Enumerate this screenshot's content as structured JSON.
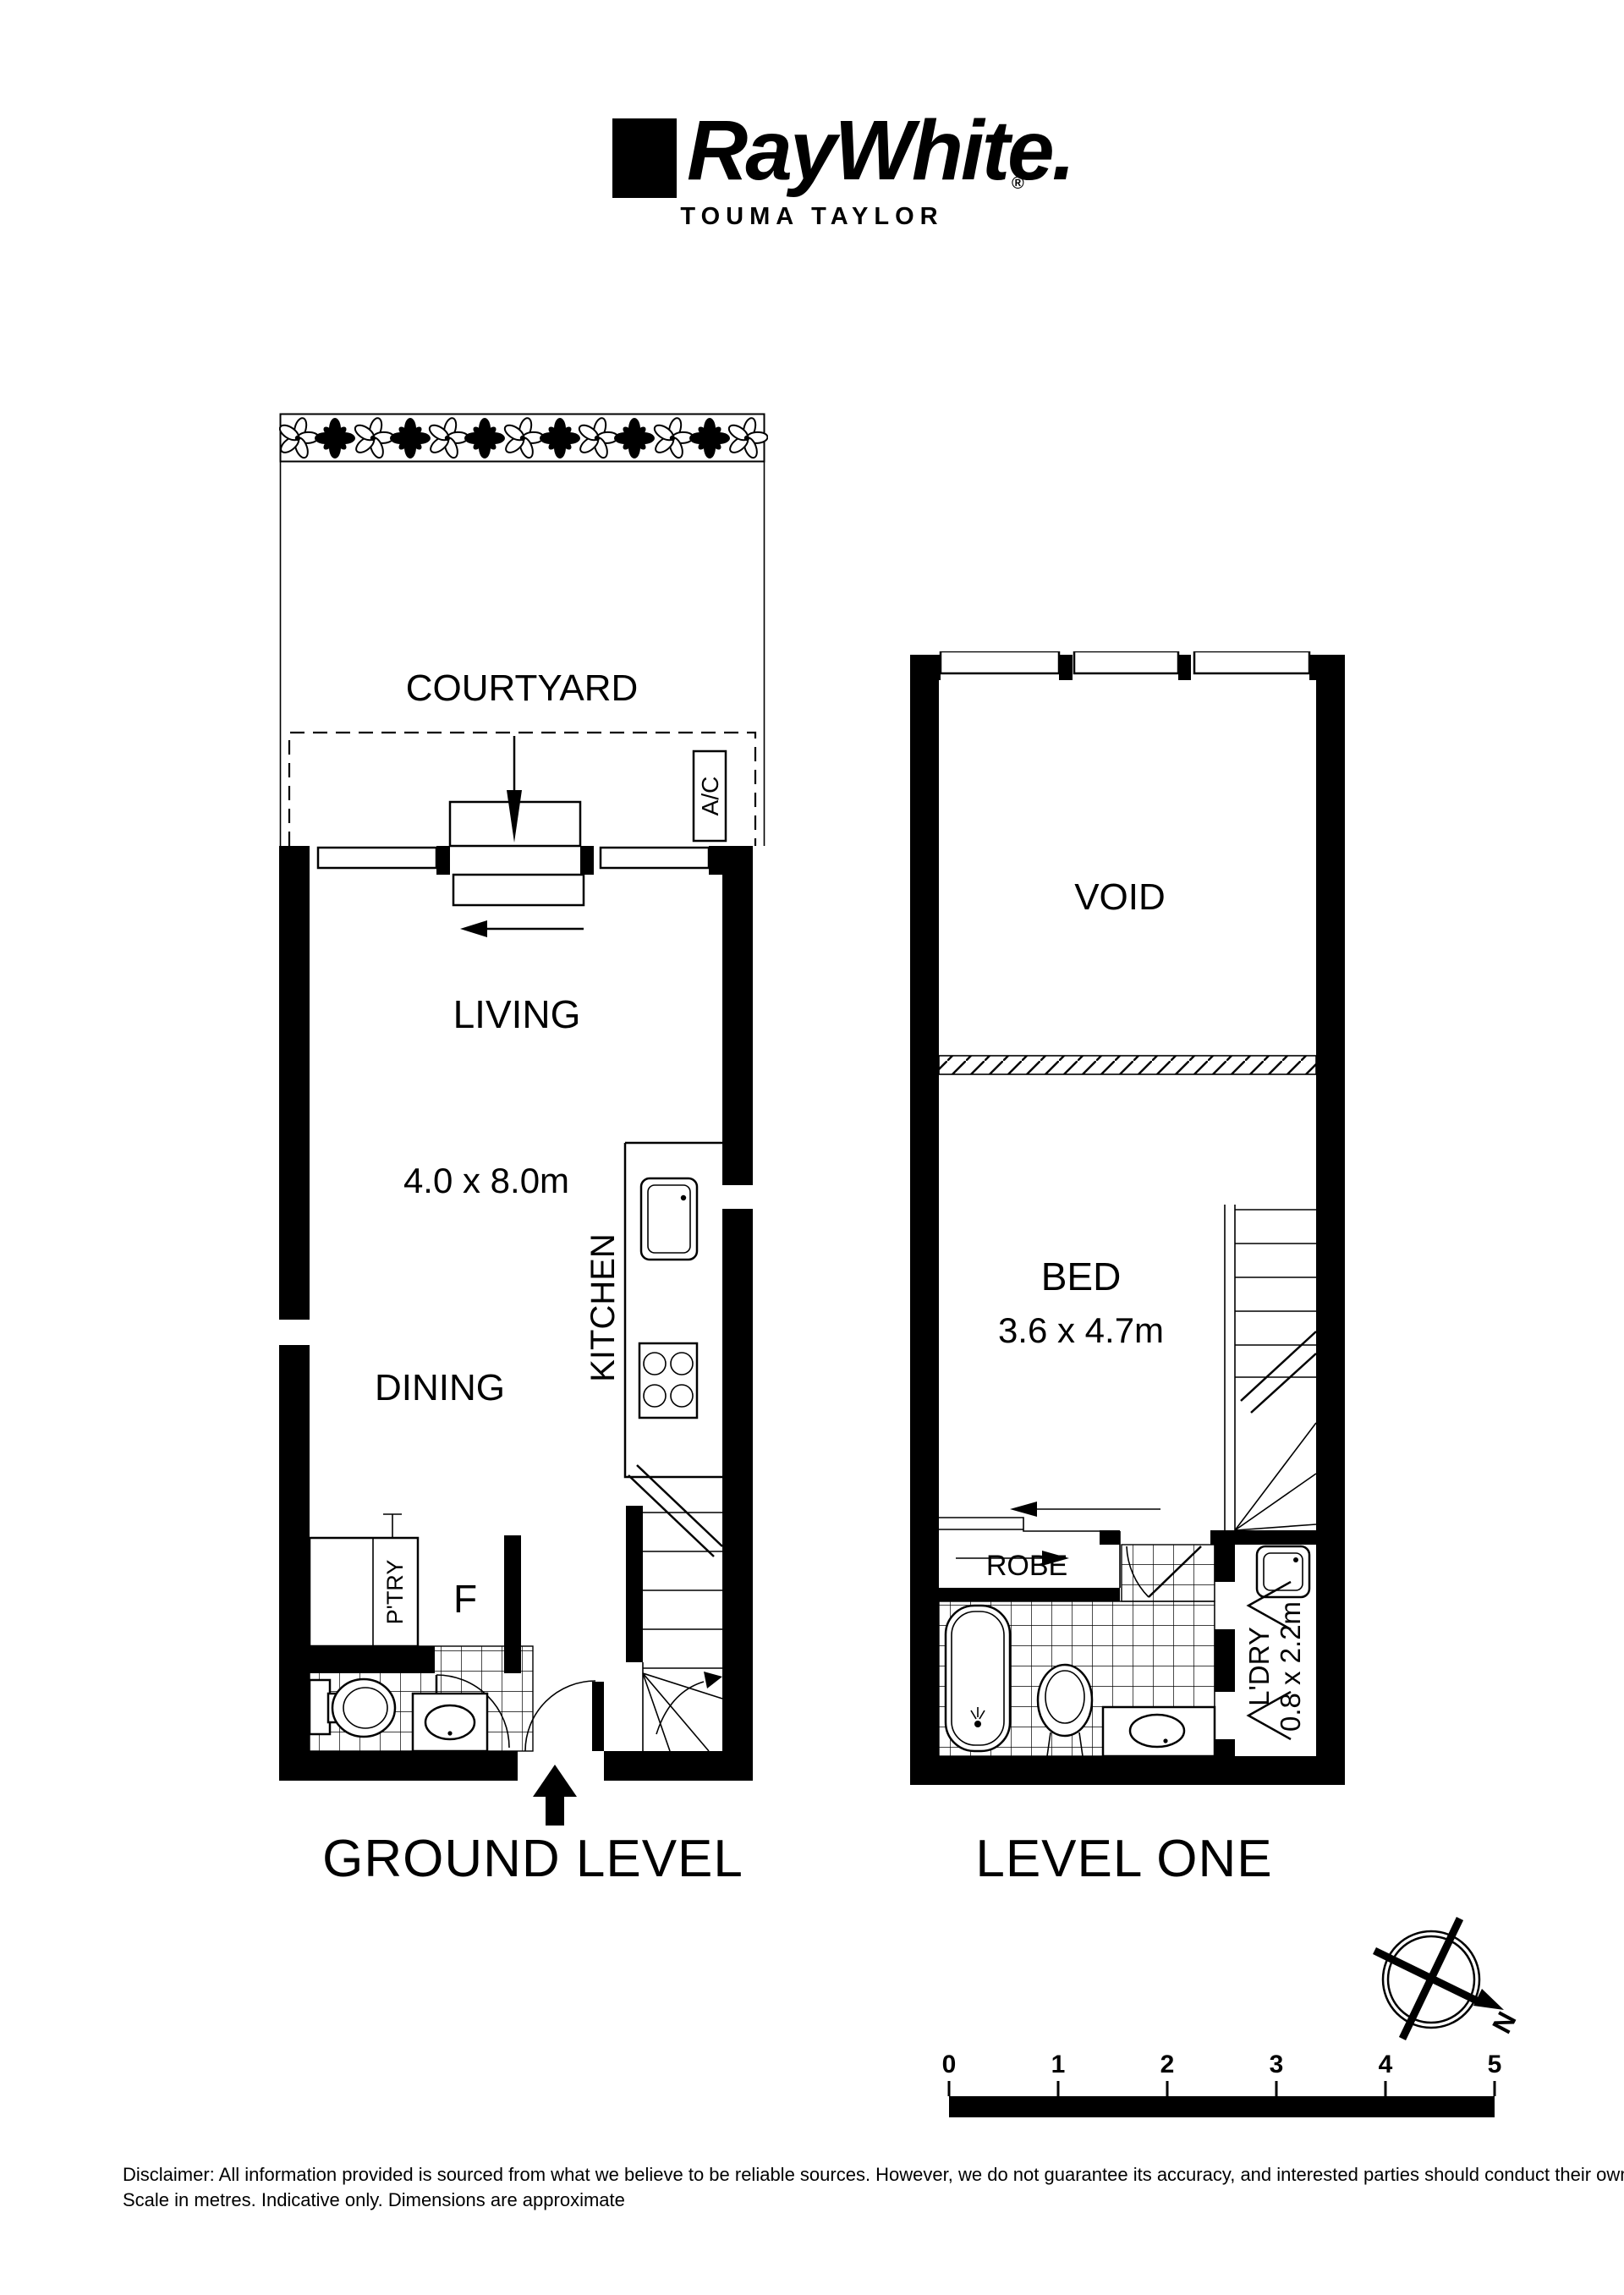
{
  "header": {
    "brand": "RayWhite.",
    "registered_mark": "®",
    "office": "TOUMA TAYLOR"
  },
  "ground_level": {
    "label": "GROUND LEVEL",
    "rooms": {
      "courtyard": "COURTYARD",
      "ac": "A/C",
      "living": "LIVING",
      "living_dims": "4.0 x 8.0m",
      "kitchen": "KITCHEN",
      "dining": "DINING",
      "pantry": "P'TRY",
      "fridge": "F"
    }
  },
  "level_one": {
    "label": "LEVEL ONE",
    "rooms": {
      "void": "VOID",
      "bed": "BED",
      "bed_dims": "3.6 x 4.7m",
      "robe": "ROBE",
      "laundry": "L'DRY",
      "laundry_dims": "0.8 x 2.2m"
    }
  },
  "compass": {
    "north_label": "N"
  },
  "scale_bar": {
    "ticks": [
      "0",
      "1",
      "2",
      "3",
      "4",
      "5"
    ]
  },
  "footer": {
    "disclaimer_line1": "Disclaimer: All information provided is sourced from what we believe to be reliable sources. However, we do not guarantee  its accuracy, and interested parties should conduct their own enquiries.",
    "disclaimer_line2": "Scale in metres. Indicative only. Dimensions are approximate"
  }
}
